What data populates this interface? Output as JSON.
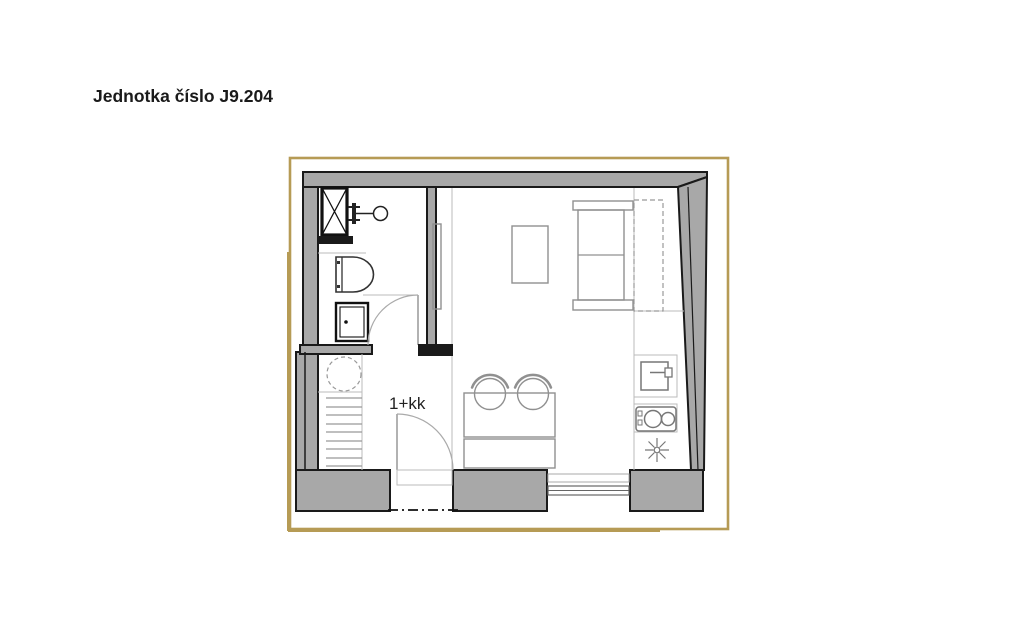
{
  "header": {
    "title": "Jednotka číslo J9.204"
  },
  "plan": {
    "unit_type_label": "1+kk",
    "colors": {
      "frame": "#b69b55",
      "wall_fill": "#a8a8a8",
      "wall_outline": "#1a1a1a",
      "furniture_line": "#909090",
      "fixture_dark": "#222222"
    },
    "fixtures": [
      "ventilation-shaft",
      "washbasin",
      "toilet",
      "washing-machine",
      "bathroom-door",
      "water-heater",
      "storage-shelves",
      "entry-door",
      "dining-table",
      "dining-chair",
      "bench",
      "coffee-table",
      "bed",
      "wardrobe",
      "kitchen-sink",
      "cooktop",
      "ceiling-light",
      "window",
      "section-line"
    ]
  }
}
